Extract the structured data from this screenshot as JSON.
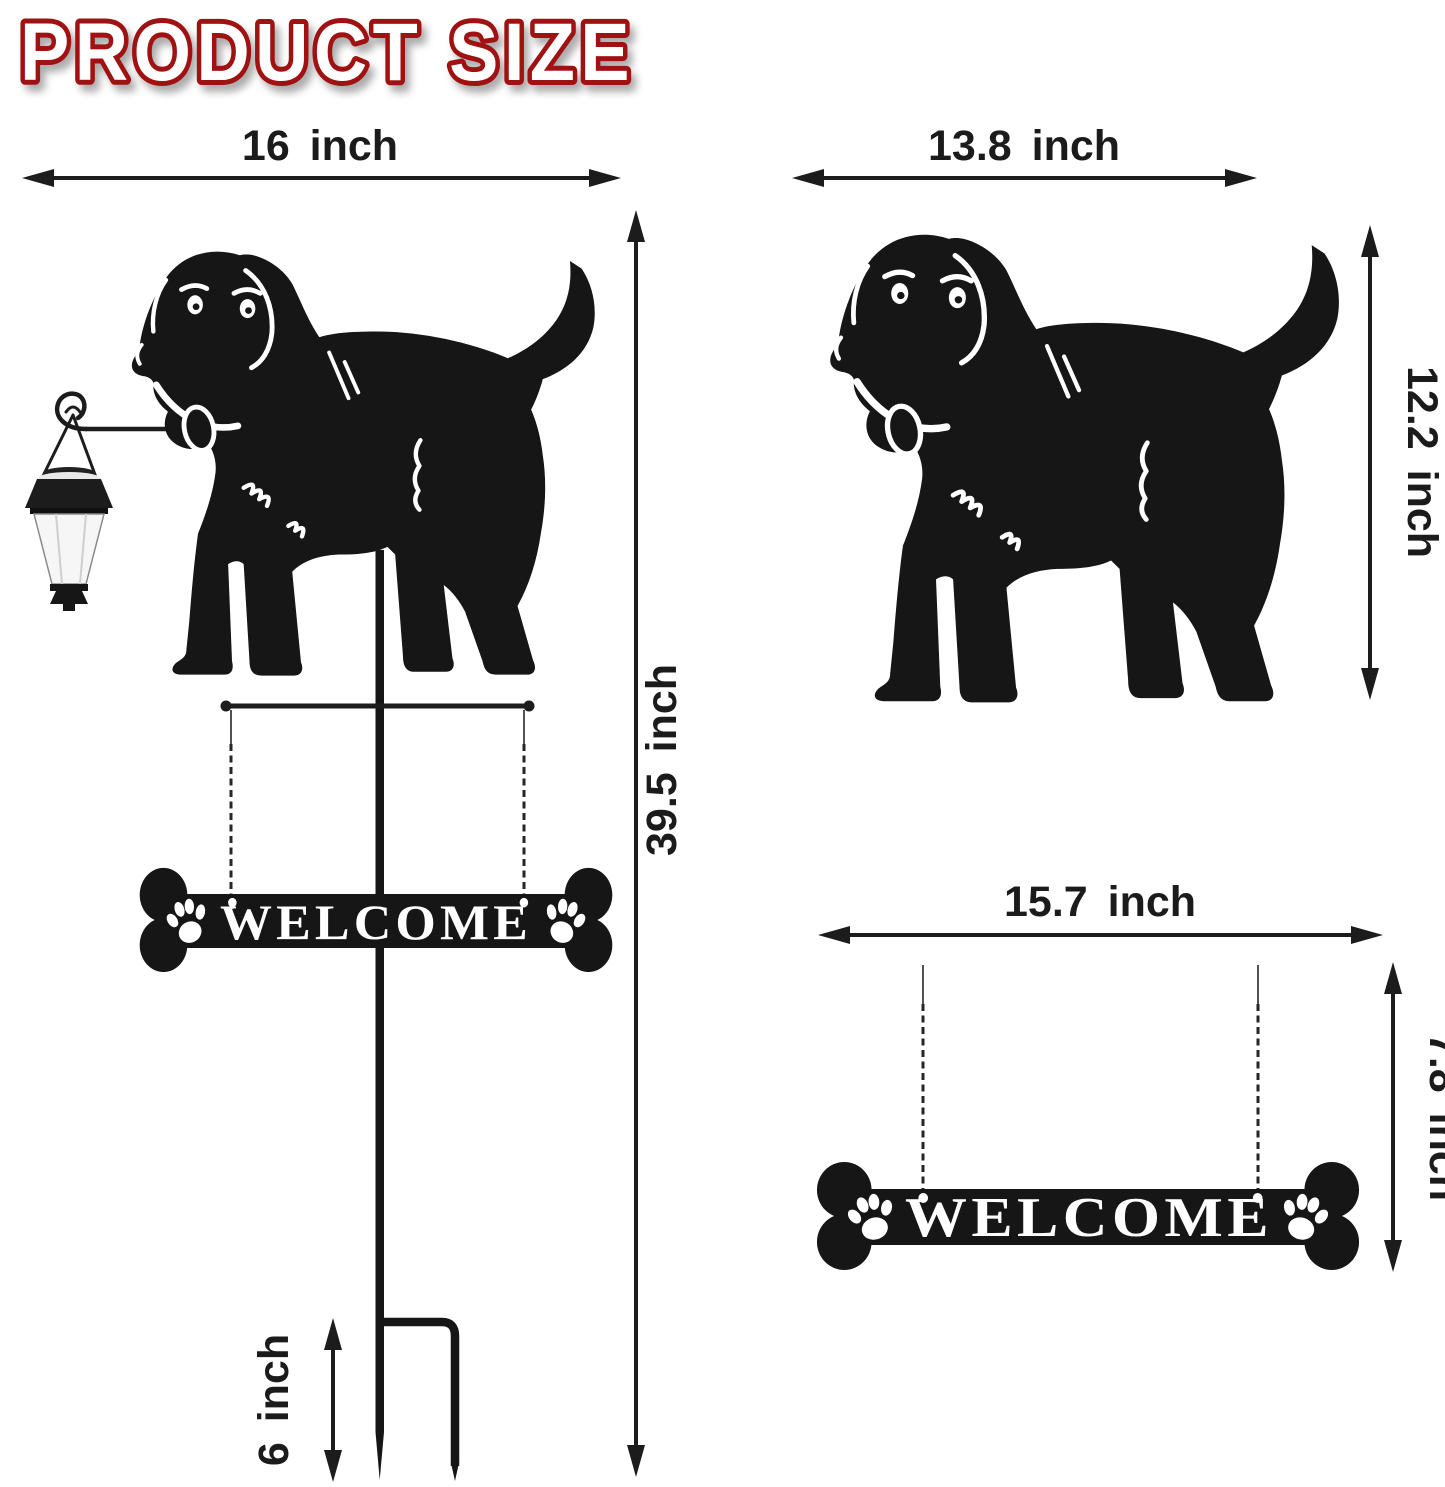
{
  "title": "PRODUCT SIZE",
  "colors": {
    "title_fill": "#ffffff",
    "title_outline": "#a01212",
    "ink": "#1c1c1c",
    "silhouette": "#161616",
    "lantern_body": "#f6f6f6"
  },
  "left_product": {
    "width_label": "16 inch",
    "height_label": "39.5 inch",
    "stake_height_label": "6 inch",
    "sign_text": "WELCOME"
  },
  "dog_panel": {
    "width_label": "13.8 inch",
    "height_label": "12.2 inch"
  },
  "sign_panel": {
    "width_label": "15.7 inch",
    "height_label": "7.8 inch",
    "sign_text": "WELCOME"
  }
}
